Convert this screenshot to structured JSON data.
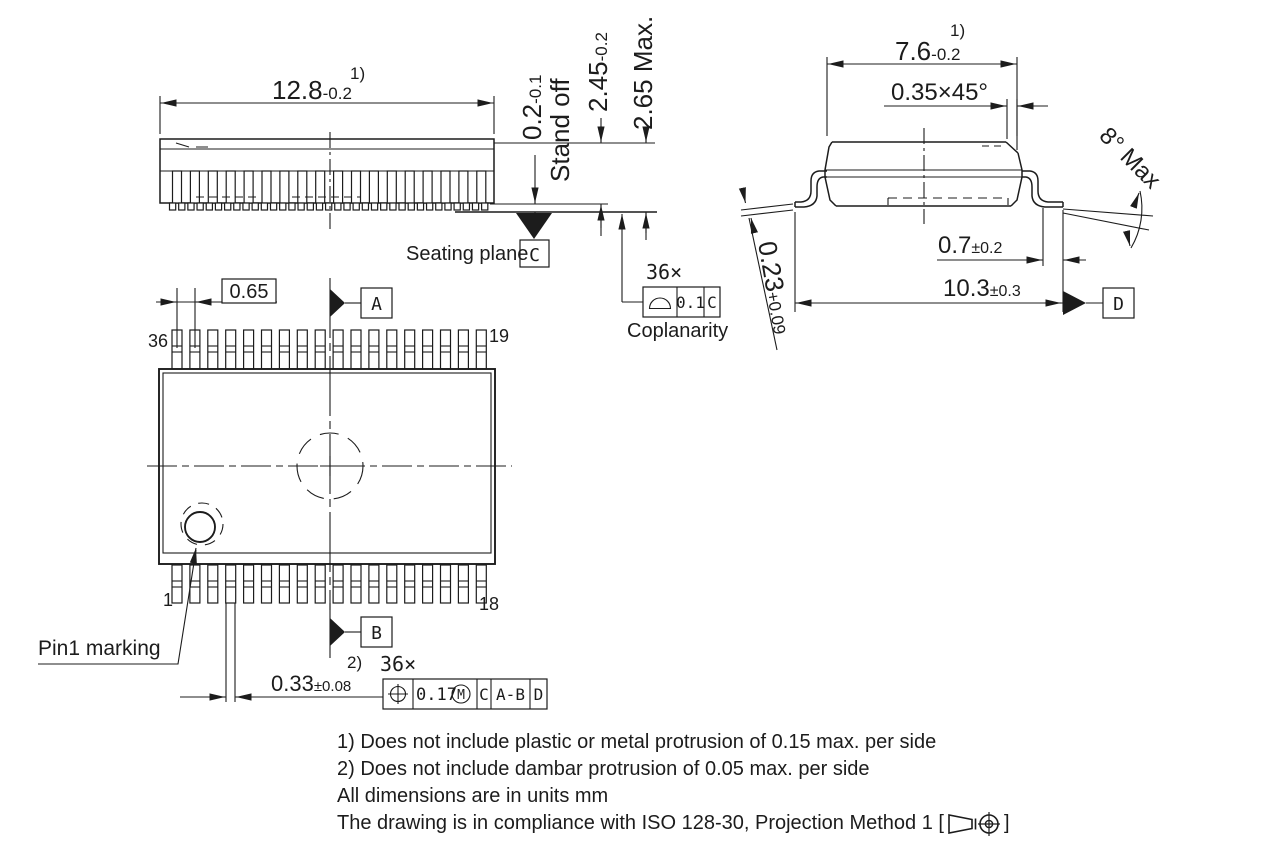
{
  "drawing": {
    "side_view": {
      "dim_width_main": "12.8",
      "dim_width_tol": "-0.2",
      "dim_width_note": "1)",
      "standoff_main": "0.2",
      "standoff_tol": "-0.1",
      "standoff_label": "Stand off",
      "body_height_main": "2.45",
      "body_height_tol": "-0.2",
      "max_height": "2.65 Max.",
      "seating_plane_label": "Seating plane",
      "datum_c": "C",
      "coplanarity_count": "36×",
      "coplanarity_tol": "0.1",
      "coplanarity_datum": "C",
      "coplanarity_label": "Coplanarity"
    },
    "end_view": {
      "dim_width_main": "7.6",
      "dim_width_tol": "-0.2",
      "dim_width_note": "1)",
      "chamfer": "0.35×45°",
      "lead_angle": "8° Max",
      "foot_main": "0.7",
      "foot_tol": "±0.2",
      "span_main": "10.3",
      "span_tol": "±0.3",
      "lead_thickness_main": "0.23",
      "lead_thickness_tol": "+0.09",
      "datum_d": "D"
    },
    "top_view": {
      "pitch": "0.65",
      "datum_a": "A",
      "datum_b": "B",
      "pin36": "36",
      "pin19": "19",
      "pin1": "1",
      "pin18": "18",
      "pin1_label": "Pin1 marking",
      "lead_width_main": "0.33",
      "lead_width_tol": "±0.08",
      "lead_width_note": "2)",
      "lead_width_count": "36×",
      "pos_tol": "0.17",
      "pos_modifier": "M",
      "pos_datum1": "C",
      "pos_datum2": "A-B",
      "pos_datum3": "D"
    },
    "notes": {
      "line1": "1) Does not include plastic or metal protrusion of 0.15 max. per side",
      "line2": "2) Does not include dambar protrusion of 0.05 max. per side",
      "line3": "All dimensions are in units mm",
      "line4_prefix": "The drawing is in compliance with ISO 128-30, Projection Method 1 [",
      "line4_suffix": "]"
    }
  }
}
